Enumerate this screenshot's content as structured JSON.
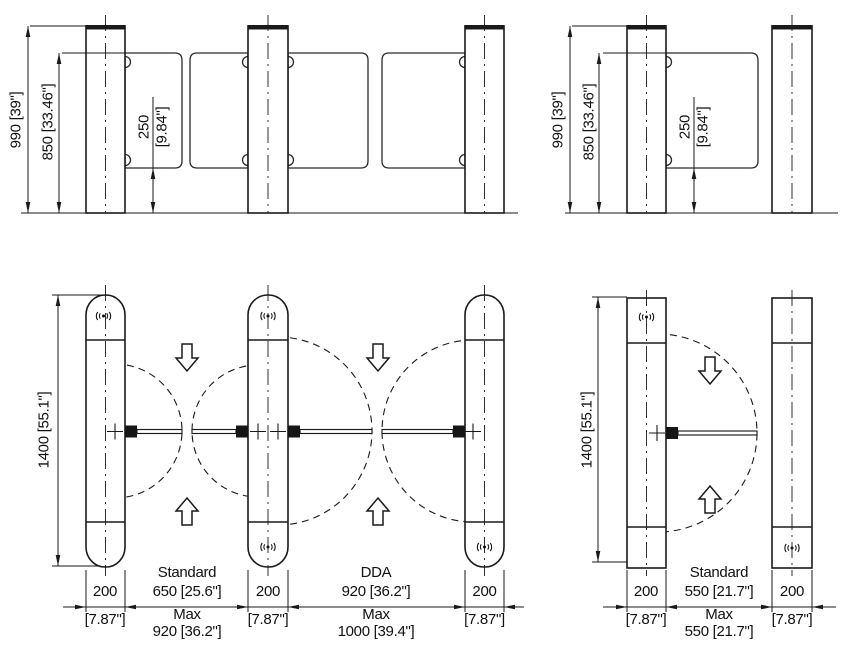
{
  "colors": {
    "line": "#1a1a1a",
    "background": "#ffffff"
  },
  "elevation": {
    "overall_height": "990 [39\"]",
    "glass_top_height": "850 [33.46\"]",
    "clearance_mm": "250",
    "clearance_in": "[9.84\"]"
  },
  "plan": {
    "cabinet_length": "1400 [55.1\"]",
    "cabinet_width_mm": "200",
    "cabinet_width_in": "[7.87\"]",
    "standard_label": "Standard",
    "dda_label": "DDA",
    "max_label": "Max",
    "standard_lane_width": "650 [25.6\"]",
    "standard_lane_max": "920 [36.2\"]",
    "dda_lane_width": "920 [36.2\"]",
    "dda_lane_max": "1000 [39.4\"]",
    "single_lane_width": "550 [21.7\"]",
    "single_lane_max": "550 [21.7\"]"
  }
}
